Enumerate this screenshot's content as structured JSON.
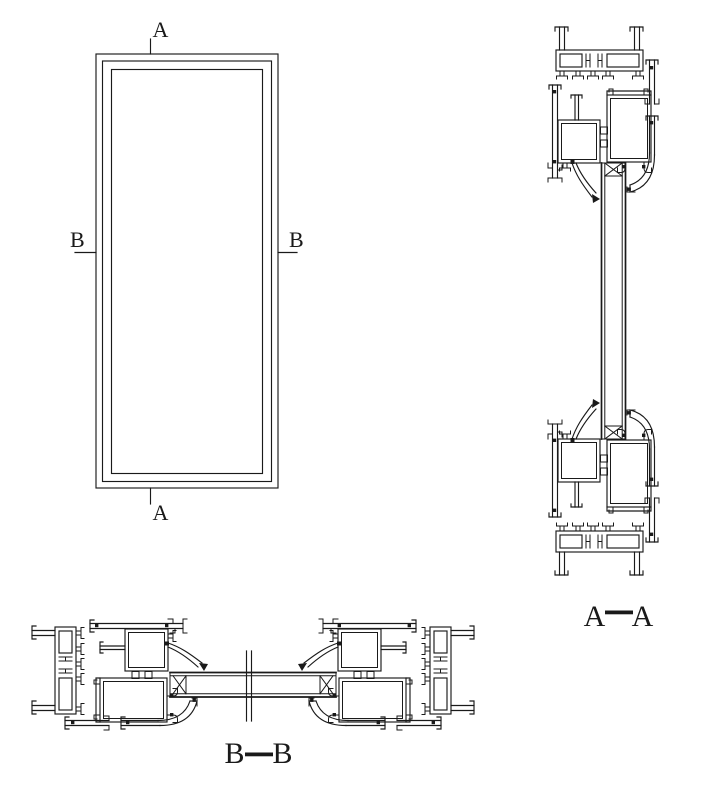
{
  "colors": {
    "background": "#ffffff",
    "line": "#1a1a1a"
  },
  "elevation": {
    "marker_a_top": "A",
    "marker_a_bottom": "A",
    "marker_b_left": "B",
    "marker_b_right": "B"
  },
  "section_aa": {
    "label_left": "A",
    "label_right": "A"
  },
  "section_bb": {
    "label_left": "B",
    "label_right": "B"
  }
}
